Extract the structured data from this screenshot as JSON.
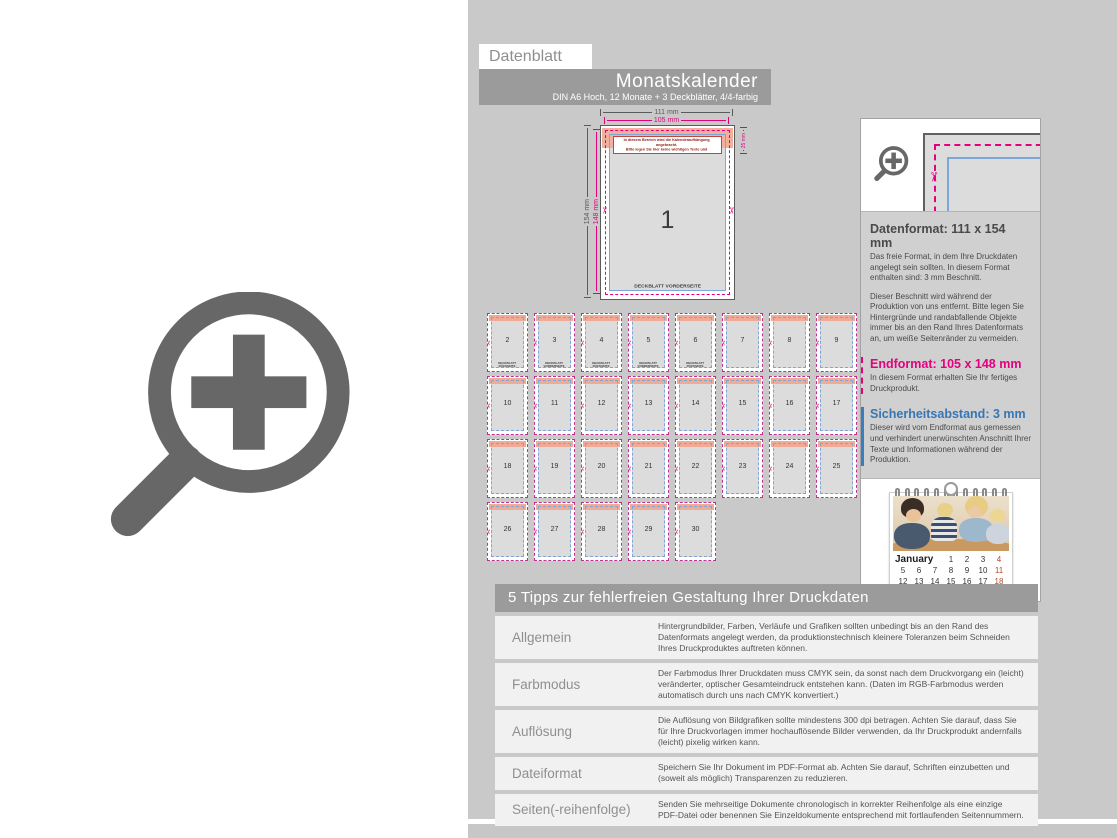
{
  "colors": {
    "accent_magenta": "#e5007d",
    "accent_blue": "#3b7bbf",
    "panel_gray": "#c9c9c9",
    "bar_gray": "#9b9b9b",
    "bleed_band_pink": "#f2af9d",
    "warning_red": "#c0392b",
    "icon_gray": "#676767"
  },
  "icons": {
    "scissors": "✂"
  },
  "header": {
    "datenblatt_label": "Datenblatt",
    "title": "Monatskalender",
    "subtitle": "DIN A6 Hoch, 12 Monate + 3 Deckblätter, 4/4-farbig"
  },
  "diagram": {
    "dim_outer_width": "111 mm",
    "dim_trim_width": "105 mm",
    "dim_outer_height": "154 mm",
    "dim_trim_height": "148 mm",
    "dim_binding": "25 mm",
    "warning_line1": "In diesem Bereich wird die Kalenderaufhängung angebracht.",
    "warning_line2": "Bitte legen Sie hier keine wichtigen Texte und Informationen an.",
    "page_number": "1",
    "page_label": "DECKBLATT VORDERSEITE"
  },
  "pages": [
    {
      "num": "2",
      "label": "DECKBLATT RÜCKSEITE"
    },
    {
      "num": "3",
      "label": "DECKBLATT VORDERSEITE"
    },
    {
      "num": "4",
      "label": "DECKBLATT RÜCKSEITE"
    },
    {
      "num": "5",
      "label": "DECKBLATT VORDERSEITE"
    },
    {
      "num": "6",
      "label": "DECKBLATT RÜCKSEITE"
    },
    {
      "num": "7",
      "label": ""
    },
    {
      "num": "8",
      "label": ""
    },
    {
      "num": "9",
      "label": ""
    },
    {
      "num": "10",
      "label": ""
    },
    {
      "num": "11",
      "label": ""
    },
    {
      "num": "12",
      "label": ""
    },
    {
      "num": "13",
      "label": ""
    },
    {
      "num": "14",
      "label": ""
    },
    {
      "num": "15",
      "label": ""
    },
    {
      "num": "16",
      "label": ""
    },
    {
      "num": "17",
      "label": ""
    },
    {
      "num": "18",
      "label": ""
    },
    {
      "num": "19",
      "label": ""
    },
    {
      "num": "20",
      "label": ""
    },
    {
      "num": "21",
      "label": ""
    },
    {
      "num": "22",
      "label": ""
    },
    {
      "num": "23",
      "label": ""
    },
    {
      "num": "24",
      "label": ""
    },
    {
      "num": "25",
      "label": ""
    },
    {
      "num": "26",
      "label": ""
    },
    {
      "num": "27",
      "label": ""
    },
    {
      "num": "28",
      "label": ""
    },
    {
      "num": "29",
      "label": ""
    },
    {
      "num": "30",
      "label": ""
    }
  ],
  "info_panel": {
    "datenformat_title": "Datenformat: 111 x 154 mm",
    "datenformat_text1": "Das freie Format, in dem Ihre Druckdaten angelegt sein sollten. In diesem Format enthalten sind: 3 mm Beschnitt.",
    "datenformat_text2": "Dieser Beschnitt wird während der Produktion von uns entfernt. Bitte legen Sie Hintergründe und randabfallende Objekte immer bis an den Rand Ihres Datenformats an, um weiße Seitenränder zu vermeiden.",
    "endformat_title": "Endformat: 105 x 148 mm",
    "endformat_text": "In diesem Format erhalten Sie Ihr fertiges Druckprodukt.",
    "sicherheit_title": "Sicherheitsabstand: 3 mm",
    "sicherheit_text": "Dieser wird vom Endformat aus gemessen und verhindert unerwünschten Anschnitt Ihrer Texte und Informationen während der Produktion."
  },
  "calendar_preview": {
    "month": "January",
    "rows": [
      [
        "1",
        "2",
        "3",
        "4"
      ],
      [
        "5",
        "6",
        "7",
        "8",
        "9",
        "10",
        "11"
      ],
      [
        "12",
        "13",
        "14",
        "15",
        "16",
        "17",
        "18"
      ]
    ]
  },
  "tips": {
    "header": "5 Tipps zur fehlerfreien Gestaltung Ihrer Druckdaten",
    "rows": [
      {
        "label": "Allgemein",
        "text": "Hintergrundbilder, Farben, Verläufe und Grafiken sollten unbedingt bis an den Rand des Datenformats angelegt werden, da produktionstechnisch kleinere Toleranzen beim Schneiden Ihres Druckproduktes auftreten können."
      },
      {
        "label": "Farbmodus",
        "text": "Der Farbmodus Ihrer Druckdaten muss CMYK sein, da sonst nach dem Druckvorgang ein (leicht) veränderter, optischer Gesamteindruck entstehen kann. (Daten im RGB-Farbmodus werden automatisch durch uns nach CMYK konvertiert.)"
      },
      {
        "label": "Auflösung",
        "text": "Die Auflösung von Bildgrafiken sollte mindestens 300 dpi betragen. Achten Sie darauf, dass Sie für Ihre Druckvorlagen immer hochauflösende Bilder verwenden, da Ihr Druckprodukt andernfalls (leicht) pixelig wirken kann."
      },
      {
        "label": "Dateiformat",
        "text": "Speichern Sie Ihr Dokument im PDF-Format ab. Achten Sie darauf, Schriften einzubetten und (soweit als möglich) Transparenzen zu reduzieren."
      },
      {
        "label": "Seiten(-reihenfolge)",
        "text": "Senden Sie mehrseitige Dokumente chronologisch in korrekter Reihenfolge als eine einzige PDF-Datei oder benennen Sie Einzeldokumente entsprechend mit fortlaufenden Seitennummern."
      }
    ]
  }
}
